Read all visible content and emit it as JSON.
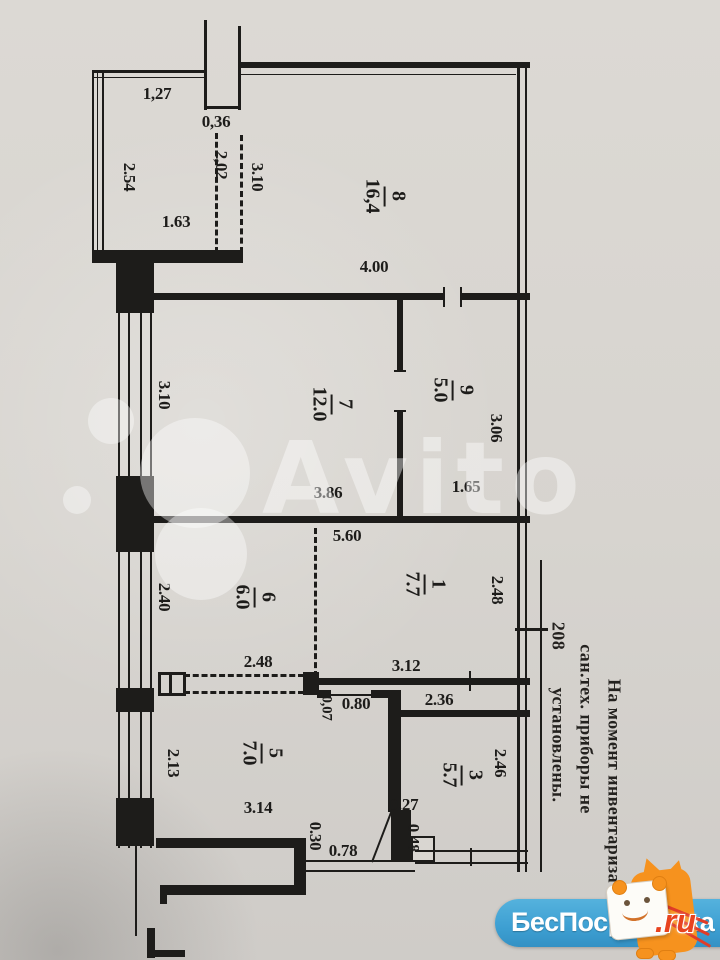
{
  "photo": {
    "watermark_text": "Avito",
    "note": {
      "line1": "На момент инвентариза",
      "line2": "сан.тех. приборы не",
      "line3": "установлены.",
      "apartment_number": "208"
    },
    "branding": {
      "site_name": "БесПосредника",
      "domain_suffix": ".ru"
    }
  },
  "floor_plan": {
    "rooms": {
      "r8": {
        "number": "8",
        "area": "16,4"
      },
      "r9": {
        "number": "9",
        "area": "5.0"
      },
      "r7": {
        "number": "7",
        "area": "12.0"
      },
      "r6": {
        "number": "6",
        "area": "6.0"
      },
      "r1": {
        "number": "1",
        "area": "7.7"
      },
      "r5": {
        "number": "5",
        "area": "7.0"
      },
      "r3": {
        "number": "3",
        "area": "5.7"
      }
    },
    "dimensions": {
      "balcony_top": "1,27",
      "balcony_left": "2.54",
      "balcony_bottom": "1.63",
      "shaft_width": "0,36",
      "partition_left": "2,02",
      "partition_right": "3.10",
      "room8_width": "4.00",
      "room9_height": "3.06",
      "room9_width": "1.65",
      "room7_width": "3.86",
      "room7_height": "3.10",
      "hall_width": "5.60",
      "room6_height": "2.40",
      "room1_height": "2.48",
      "room1_width": "3.12",
      "room3_top_width": "2.36",
      "closet_width": "2.48",
      "door_width": "0.80",
      "wall_offset": "0,07",
      "room5_height": "2.13",
      "room5_width": "3.14",
      "sill_height": "0.30",
      "sill_width": "0.78",
      "niche_width": "0.27",
      "niche_height": "0.48",
      "room3_height": "2.46"
    }
  },
  "colors": {
    "paper": "#d6d3ce",
    "ink": "#1d1c1a",
    "brand_blue": "#3d9fd2",
    "brand_orange": "#f6921e",
    "brand_red": "#e8431f",
    "watermark": "rgba(255,255,255,0.42)"
  }
}
